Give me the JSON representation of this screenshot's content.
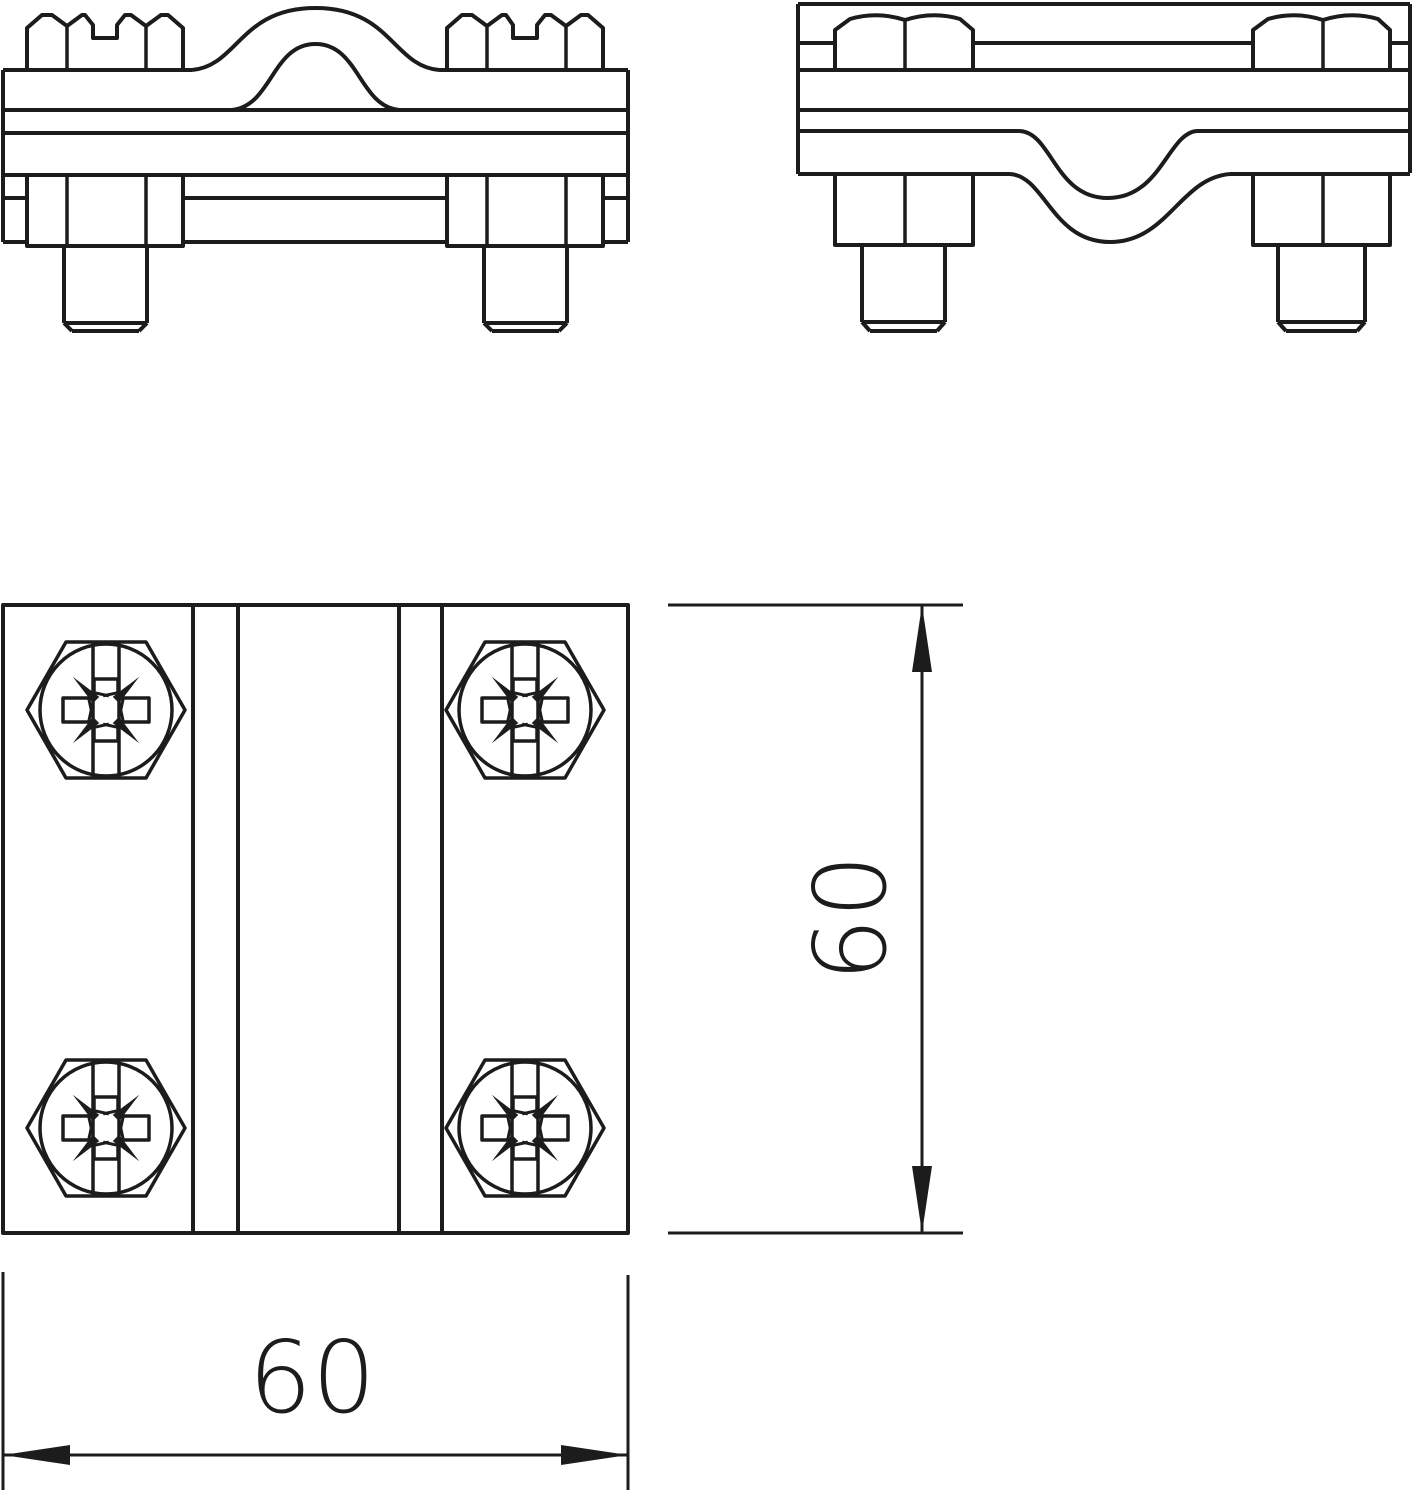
{
  "drawing": {
    "background": "#ffffff",
    "line_color": "#1c1c1c",
    "dimension_height": {
      "label": "60",
      "orientation": "vertical"
    },
    "dimension_width": {
      "label": "60",
      "orientation": "horizontal"
    }
  }
}
